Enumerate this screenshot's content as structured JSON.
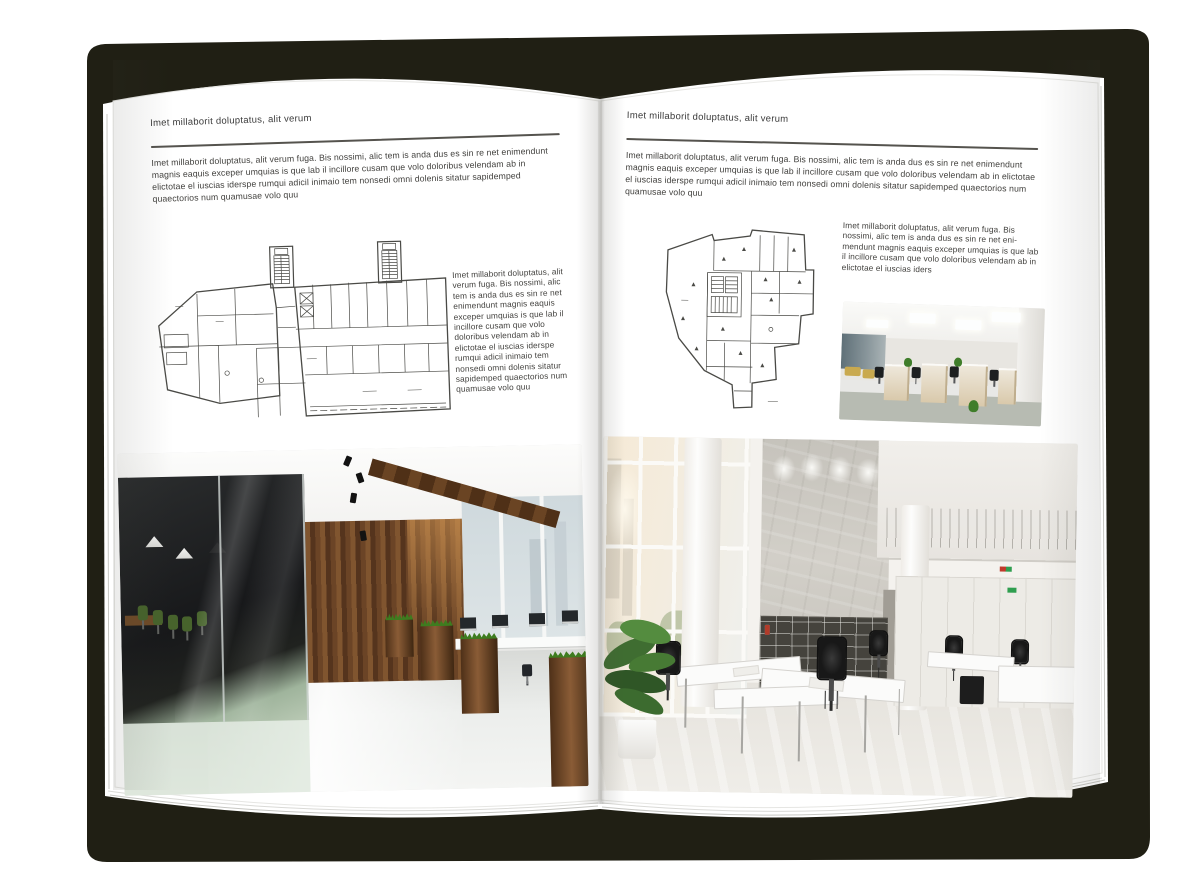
{
  "colors": {
    "cover": "#201f14",
    "page": "#ffffff",
    "rule": "#55534e"
  },
  "left_page": {
    "running_head": "Imet millaborit doluptatus, alit verum",
    "intro": "Imet millaborit doluptatus, alit verum fuga. Bis nossimi, alic tem is anda dus es sin re net enimendunt magnis eaquis exceper umquias is que lab il incillore cusam que volo doloribus velendam ab in elictotae el iuscias iderspe rumqui adicil inimaio tem nonsedi omni dolenis sitatur sapidemped quaectorios num quamusae volo quu",
    "caption": "Imet millaborit doluptatus, alit verum fuga. Bis nossimi, alic tem is anda dus es sin re net enimendunt magnis eaquis exceper umquias is que lab il incillore cusam que volo doloribus velendam ab in elictotae el iuscias iderspe rumqui adicil inimaio tem nonsedi omni dolenis sitatur sapidemped quaectorios num quamusae volo quu"
  },
  "right_page": {
    "running_head": "Imet millaborit doluptatus, alit verum",
    "intro": "Imet millaborit doluptatus, alit verum fuga. Bis nossimi, alic tem is anda dus es sin re net enimendunt magnis eaquis exceper umquias is que lab il incillore cusam que volo doloribus velendam ab in elictotae el iuscias iderspe rumqui adicil inimaio tem nonsedi omni dolenis sitatur sapidemped quaectorios num quamusae volo quu",
    "caption": "Imet millaborit doluptatus, alit verum fuga. Bis nossimi, alic tem is anda dus es sin re net eni-mendunt magnis eaquis exceper umquias is que lab il incillore cusam que volo doloribus velendam ab in elictotae el iuscias iders"
  }
}
